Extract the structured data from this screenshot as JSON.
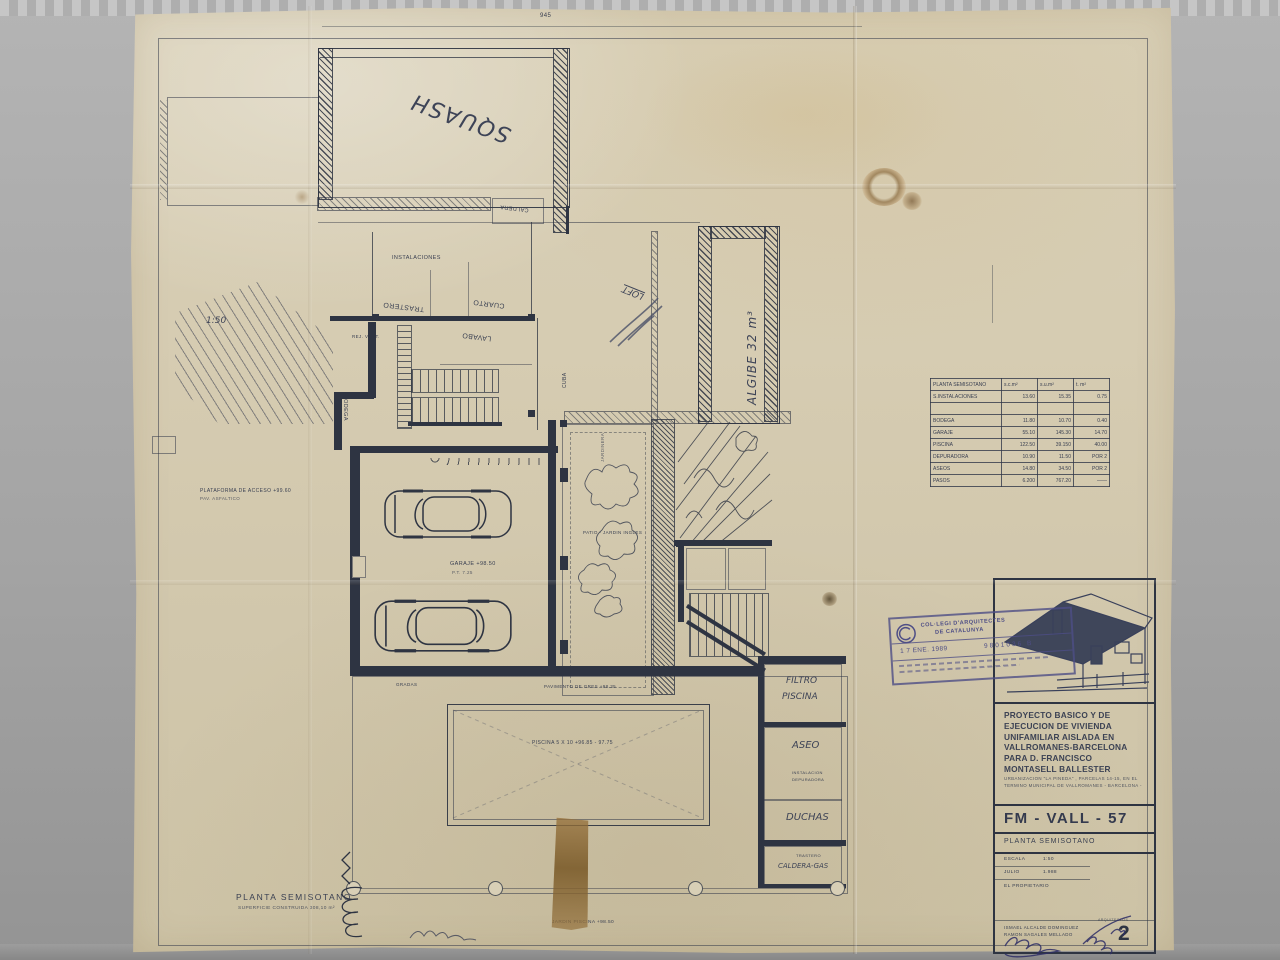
{
  "colors": {
    "ink": "#2e3442",
    "hand": "#3e4457",
    "stamp_blue": "#4e4e86",
    "paper": "#d5cbb1"
  },
  "plan": {
    "labels": {
      "dim_945": "945",
      "squash": "SQUASH",
      "caldera_top": "CALDERA",
      "instalaciones": "INSTALACIONES",
      "trastero_mid": "TRASTERO",
      "cuarto": "CUARTO",
      "lavabo": "LAVABO",
      "bodega": "BODEGA",
      "rej_vent": "REJ. VENT.",
      "cuba": "CUBA",
      "algibe": "ALGIBE   32 m³",
      "loft": "LOFT",
      "escala_hand": "1:50",
      "plataforma_1": "PLATAFORMA DE ACCESO   +99.60",
      "plataforma_2": "PAV. ASFALTICO",
      "garaje_1": "GARAJE   +98.50",
      "garaje_2": "P.T.   7.25",
      "patio": "PATIO - JARDIN INGLES",
      "jardinera": "JARDINERA",
      "pavimento": "PAVIMENTO DE GRES   +98.35",
      "gradas": "GRADAS",
      "filtro_1": "FILTRO",
      "filtro_2": "PISCINA",
      "aseo": "ASEO",
      "depuradora_1": "INSTALACION",
      "depuradora_2": "DEPURADORA",
      "duchas": "DUCHAS",
      "trastero_b": "TRASTERO",
      "caldera_gas": "CALDERA-GAS",
      "piscina": "PISCINA  5 X 10    +96.85 - 97.75",
      "jardin_piscina": "JARDIN PISCINA  +98.50",
      "planta_caption_1": "PLANTA  SEMISOTANO",
      "planta_caption_2": "SUPERFICIE  CONSTRUIDA   308,10 m²"
    }
  },
  "table": {
    "title": "PLANTA    SEMISOTANO",
    "col_headers": [
      "s.c.m²",
      "s.u.m²",
      "t. m²"
    ],
    "rows": [
      [
        "S.INSTALACIONES",
        "13.60",
        "15.35",
        "0.75"
      ],
      [
        "",
        "",
        "",
        ""
      ],
      [
        "BODEGA",
        "11.80",
        "10.70",
        "0.40"
      ],
      [
        "GARAJE",
        "55.10",
        "145.30",
        "14.70"
      ],
      [
        "PISCINA",
        "122.50",
        "39.150",
        "40.00"
      ],
      [
        "DEPURADORA",
        "10.90",
        "11.50",
        "POR 2"
      ],
      [
        "ASEOS",
        "14.80",
        "34.50",
        "POR 2"
      ],
      [
        "PASOS",
        "6.200",
        "767.20",
        "——"
      ]
    ]
  },
  "titleblock": {
    "project": "PROYECTO BASICO Y DE EJECUCION DE VIVIENDA UNIFAMILIAR AISLADA EN VALLROMANES-BARCELONA PARA D. FRANCISCO MONTASELL BALLESTER",
    "location": "URBANIZACION \"LA PINEDA\" , PARCELAS 14-15, EN EL TERMINO MUNICIPAL DE VALLROMANES  - BARCELONA -",
    "code": "FM - VALL - 57",
    "sheet": "PLANTA  SEMISOTANO",
    "escala_label": "ESCALA",
    "escala_value": "1:50",
    "mes": "JULIO",
    "anyo": "1.988",
    "propietario": "EL  PROPIETARIO",
    "arch1": "ISMAEL  ALCALDE  DOMINGUEZ",
    "arch2": "RAMON  SAGALES  MELLADO",
    "arch_label": "ARQUITECTOS",
    "page": "2"
  },
  "stamp": {
    "org1": "COL·LEGI  D'ARQUITECTES",
    "org2": "DE  CATALUNYA",
    "date": "1 7  ENE. 1989",
    "number": "9801036 B"
  }
}
